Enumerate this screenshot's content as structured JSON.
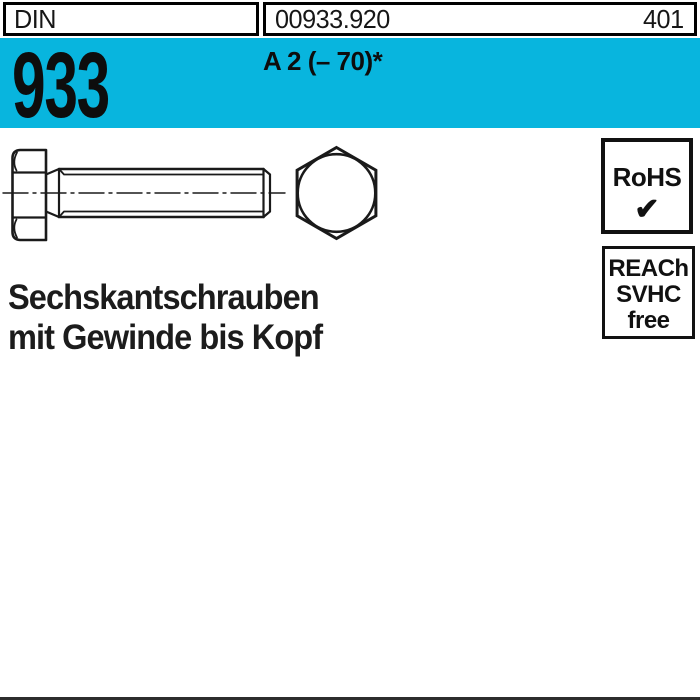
{
  "header": {
    "din_label": "DIN",
    "article_number": "00933.920",
    "page_number": "401",
    "standard_number": "933",
    "material_grade": "A 2 (– 70)*"
  },
  "badges": {
    "rohs": {
      "label": "RoHS",
      "check_icon": "✔"
    },
    "reach": {
      "line1": "REACh",
      "line2": "SVHC",
      "line3": "free"
    }
  },
  "product": {
    "title_line1": "Sechskantschrauben",
    "title_line2": "mit Gewinde bis Kopf"
  },
  "drawing": {
    "description": "DIN 933 hex head bolt, side view with full thread and hex head front view"
  },
  "colors": {
    "accent_cyan": "#08b5de",
    "line_black": "#1a1a1a"
  }
}
